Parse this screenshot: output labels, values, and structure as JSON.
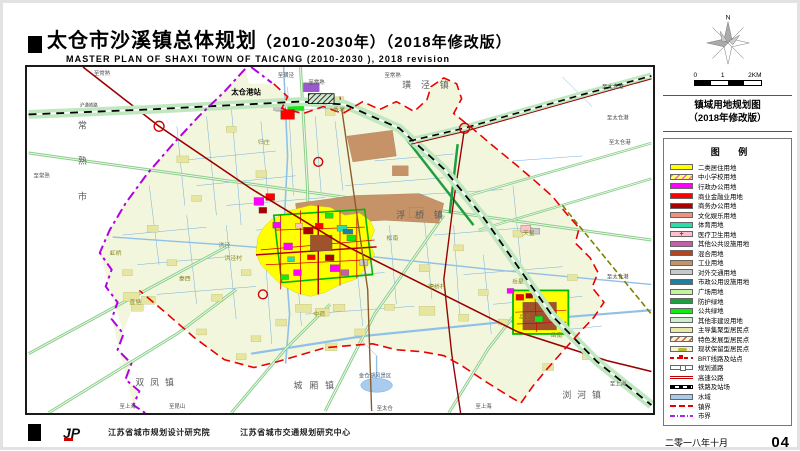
{
  "header": {
    "title_zh": "太仓市沙溪镇总体规划",
    "title_suffix": "（2010-2030年）（2018年修改版）",
    "title_en": "MASTER PLAN OF SHAXI TOWN OF TAICANG (2010-2030 ), 2018 revision"
  },
  "side": {
    "north_label": "N",
    "scale_ticks": [
      "0",
      "1",
      "2KM"
    ],
    "map_title_line1": "镇域用地规划图",
    "map_title_line2": "（2018年修改版）",
    "legend_title": "图 例",
    "date": "二零一八年十月",
    "page_number": "04"
  },
  "legend": {
    "items": [
      {
        "label": "二类居住用地",
        "type": "fill",
        "color": "#FFFF00"
      },
      {
        "label": "中小学校用地",
        "type": "hatch",
        "color": "#FFFF66",
        "mark": "#FF60C0"
      },
      {
        "label": "行政办公用地",
        "type": "fill",
        "color": "#FF00FF"
      },
      {
        "label": "商业金融业用地",
        "type": "fill",
        "color": "#FF0000"
      },
      {
        "label": "商务办公用地",
        "type": "fill",
        "color": "#AA0000"
      },
      {
        "label": "文化娱乐用地",
        "type": "fill",
        "color": "#F2907E"
      },
      {
        "label": "体育用地",
        "type": "fill",
        "color": "#2EDCA8"
      },
      {
        "label": "医疗卫生用地",
        "type": "cross",
        "color": "#FFC0CB",
        "mark": "#FF0000"
      },
      {
        "label": "其他公共设施用地",
        "type": "fill",
        "color": "#C45FA8"
      },
      {
        "label": "混合用地",
        "type": "fill",
        "color": "#B5451F"
      },
      {
        "label": "工业用地",
        "type": "fill",
        "color": "#C69368"
      },
      {
        "label": "对外交通用地",
        "type": "fill",
        "color": "#C9C9C9"
      },
      {
        "label": "市政公用设施用地",
        "type": "fill",
        "color": "#1F7FA0"
      },
      {
        "label": "广场用地",
        "type": "fill",
        "color": "#C2F49E"
      },
      {
        "label": "防护绿地",
        "type": "fill",
        "color": "#1F9E3F"
      },
      {
        "label": "公共绿地",
        "type": "fill",
        "color": "#12E812"
      },
      {
        "label": "其他非建设用地",
        "type": "fill",
        "color": "#CDEECB"
      },
      {
        "label": "主导集聚型居民点",
        "type": "fill",
        "color": "#E9E9A6"
      },
      {
        "label": "特色发展型居民点",
        "type": "hatch",
        "color": "#F6F2CC",
        "mark": "#E05050"
      },
      {
        "label": "现状保留型居民点",
        "type": "blob",
        "color": "#F6F2CC",
        "mark": "#b8b838"
      },
      {
        "label": "BRT线路及站点",
        "type": "line-brt",
        "color": "#E00000"
      },
      {
        "label": "规划道路",
        "type": "line-road",
        "color": "#666666"
      },
      {
        "label": "高速公路",
        "type": "line-expy",
        "color": "#C00000"
      },
      {
        "label": "铁路及站场",
        "type": "line-rail",
        "color": "#000000"
      },
      {
        "label": "水域",
        "type": "fill",
        "color": "#A9CBEE"
      },
      {
        "label": "镇界",
        "type": "line-townb",
        "color": "#E80000"
      },
      {
        "label": "市界",
        "type": "line-cityb",
        "color": "#A928E0"
      }
    ]
  },
  "map": {
    "labels": [
      {
        "t": "璜泾镇",
        "x": 378,
        "y": 21,
        "cls": "t-town",
        "ls": 10
      },
      {
        "t": "浮桥镇",
        "x": 372,
        "y": 153,
        "cls": "t-town",
        "ls": 10
      },
      {
        "t": "双凤镇",
        "x": 108,
        "y": 322,
        "cls": "t-town",
        "ls": 6
      },
      {
        "t": "城厢镇",
        "x": 268,
        "y": 325,
        "cls": "t-town",
        "ls": 7
      },
      {
        "t": "浏河镇",
        "x": 540,
        "y": 335,
        "cls": "t-town",
        "ls": 6
      },
      {
        "t": "常熟市",
        "x": 50,
        "y": 62,
        "cls": "t-town",
        "v": 36
      },
      {
        "t": "太仓港站",
        "x": 205,
        "y": 28,
        "cls": "t-station"
      },
      {
        "t": "归庄",
        "x": 232,
        "y": 78,
        "cls": "t-vill"
      },
      {
        "t": "香塘",
        "x": 308,
        "y": 45,
        "cls": "t-vill"
      },
      {
        "t": "洪泾",
        "x": 192,
        "y": 182,
        "cls": "t-vill"
      },
      {
        "t": "洪泾村",
        "x": 198,
        "y": 195,
        "cls": "t-vill"
      },
      {
        "t": "虹桥",
        "x": 82,
        "y": 190,
        "cls": "t-vill"
      },
      {
        "t": "泰西",
        "x": 152,
        "y": 216,
        "cls": "t-vill"
      },
      {
        "t": "松南",
        "x": 362,
        "y": 175,
        "cls": "t-vill"
      },
      {
        "t": "中荷",
        "x": 288,
        "y": 252,
        "cls": "t-vill"
      },
      {
        "t": "直塘",
        "x": 102,
        "y": 240,
        "cls": "t-vill"
      },
      {
        "t": "岳星",
        "x": 489,
        "y": 219,
        "cls": "t-vill"
      },
      {
        "t": "岳王",
        "x": 496,
        "y": 255,
        "cls": "t-vill"
      },
      {
        "t": "岳南",
        "x": 528,
        "y": 273,
        "cls": "t-vill"
      },
      {
        "t": "天星",
        "x": 500,
        "y": 170,
        "cls": "t-vill"
      },
      {
        "t": "德桥村",
        "x": 404,
        "y": 224,
        "cls": "t-vill"
      },
      {
        "t": "金仓湖风景区",
        "x": 334,
        "y": 314,
        "cls": "t-scenic"
      },
      {
        "t": "至常熟",
        "x": 66,
        "y": 8,
        "cls": "t-road"
      },
      {
        "t": "至璜泾",
        "x": 252,
        "y": 10,
        "cls": "t-road"
      },
      {
        "t": "至常熟",
        "x": 283,
        "y": 17,
        "cls": "t-road"
      },
      {
        "t": "至常熟",
        "x": 360,
        "y": 10,
        "cls": "t-road"
      },
      {
        "t": "至常熟",
        "x": 5,
        "y": 112,
        "cls": "t-road"
      },
      {
        "t": "至太仓港",
        "x": 580,
        "y": 22,
        "cls": "t-road"
      },
      {
        "t": "至太仓港",
        "x": 585,
        "y": 53,
        "cls": "t-road"
      },
      {
        "t": "至太仓港",
        "x": 587,
        "y": 78,
        "cls": "t-road"
      },
      {
        "t": "至太仓港",
        "x": 585,
        "y": 214,
        "cls": "t-road"
      },
      {
        "t": "至上海",
        "x": 92,
        "y": 345,
        "cls": "t-road"
      },
      {
        "t": "至昆山",
        "x": 142,
        "y": 345,
        "cls": "t-road"
      },
      {
        "t": "至上海",
        "x": 452,
        "y": 345,
        "cls": "t-road"
      },
      {
        "t": "至太仓",
        "x": 352,
        "y": 347,
        "cls": "t-road"
      },
      {
        "t": "至上海",
        "x": 588,
        "y": 322,
        "cls": "t-road"
      },
      {
        "t": "沪通铁路",
        "x": 52,
        "y": 40,
        "cls": "t-rail"
      }
    ]
  },
  "footer": {
    "logo": "JP",
    "org1": "江苏省城市规划设计研究院",
    "org2": "江苏省城市交通规划研究中心"
  }
}
